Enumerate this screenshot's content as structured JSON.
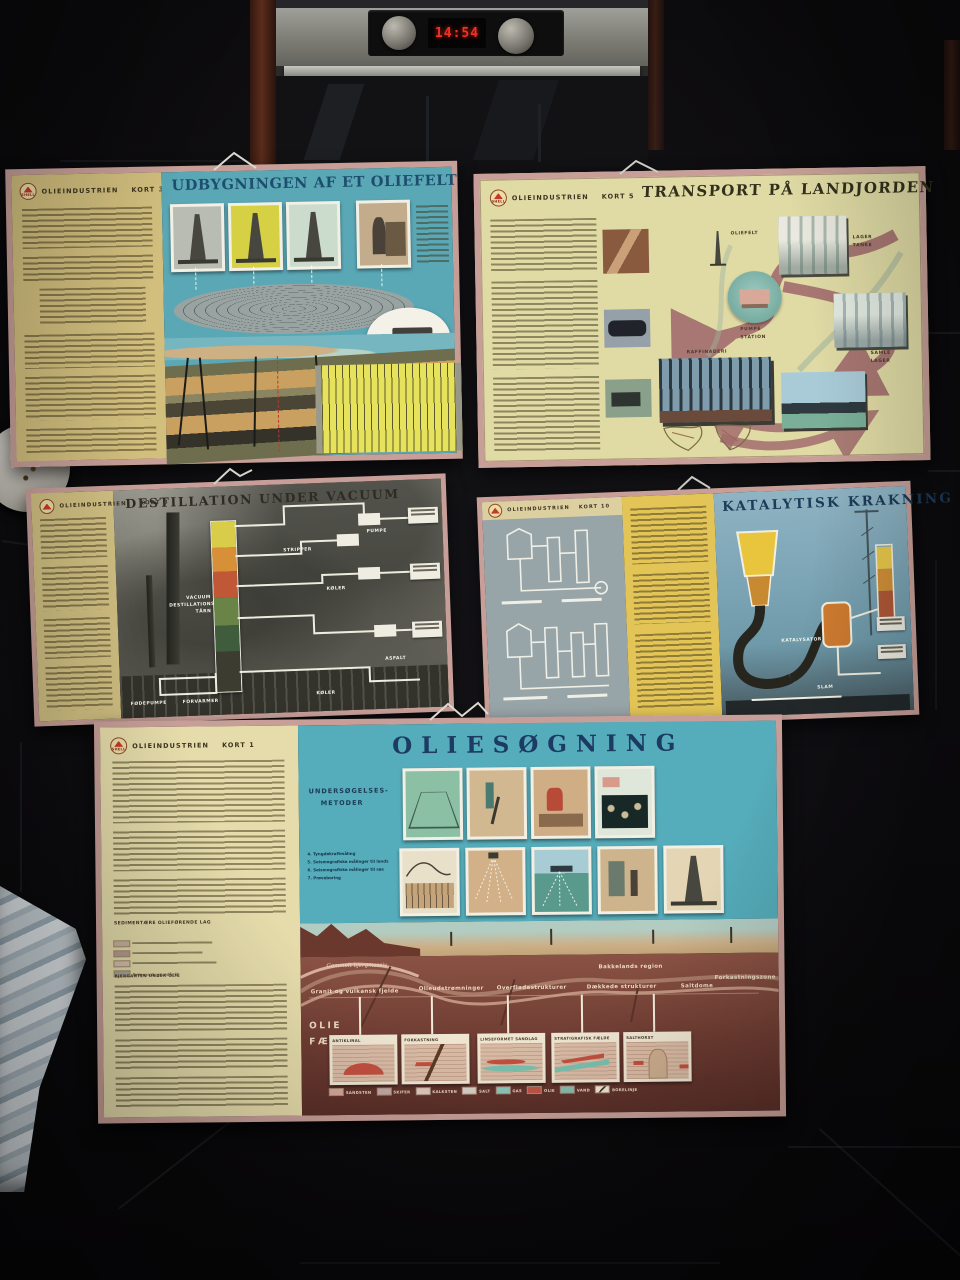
{
  "scene": {
    "clock_time": "14:54",
    "brand": "SHELL"
  },
  "p1": {
    "series": "OLIEINDUSTRIEN",
    "kort": "KORT 3",
    "title": "UDBYGNINGEN AF ET OLIEFELT"
  },
  "p2": {
    "series": "OLIEINDUSTRIEN",
    "kort": "KORT 5",
    "title": "TRANSPORT PÅ LANDJORDEN",
    "oliefelt": "OLIEFELT",
    "lager1": "LAGER",
    "lager2": "TANKE",
    "pumpe1": "PUMPE",
    "pumpe2": "STATION",
    "samle1": "SAMLE",
    "samle2": "LAGER",
    "raffinaderi": "RAFFINADERI"
  },
  "p3": {
    "series": "OLIEINDUSTRIEN",
    "kort": "KORT 8",
    "title": "DESTILLATION UNDER VACUUM",
    "taarn": "VACUUM DESTILLATIONS TÅRN",
    "foedepumpe": "FØDEPUMPE",
    "forvarmer": "FORVARMER",
    "stripper": "STRIPPER",
    "koeler": "KØLER",
    "pumpe": "PUMPE",
    "asfalt": "ASFALT"
  },
  "p4": {
    "series": "OLIEINDUSTRIEN",
    "kort": "KORT 10",
    "title": "KATALYTISK KRAKNING",
    "katalysator": "KATALYSATOR",
    "slam": "SLAM"
  },
  "p5": {
    "series": "OLIEINDUSTRIEN",
    "kort": "KORT 1",
    "title": "OLIESØGNING",
    "metoder1": "UNDERSØGELSES-",
    "metoder2": "METODER",
    "methods": [
      "4. Tyngdekraftmåling",
      "5. Seismografiske målinger til lands",
      "6. Seismografiske målinger til søs",
      "7. Prøveboring"
    ],
    "strata_heading": "SEDIMENTÆRE OLIEFØRENDE LAG",
    "strata_note": "Palæozoisk grundfjeld",
    "under_olie": "BJERGARTEN UNDER OLIE",
    "reg_vt": "Gammelt bjergmassiv",
    "reg_vb": "Granit og vulkansk fjelde",
    "reg1": "Olieudstrømninger",
    "reg2": "Overfladestrukturer",
    "reg_c": "Bakkelands region",
    "reg3": "Dækkede strukturer",
    "reg4": "Saltdome",
    "reg5": "Forkastningszone",
    "faelder1": "OLIE",
    "faelder2": "FÆLDER",
    "traps": [
      "ANTIKLINAL",
      "FORKASTNING",
      "LINSEFORMET SANDLAG",
      "STRATIGRAFISK FÆLDE",
      "SALTHORST"
    ],
    "legend": [
      "SANDSTEN",
      "SKIFER",
      "KALKSTEN",
      "SALT",
      "GAS",
      "OLIE",
      "VAND",
      "BORELINJE"
    ]
  }
}
